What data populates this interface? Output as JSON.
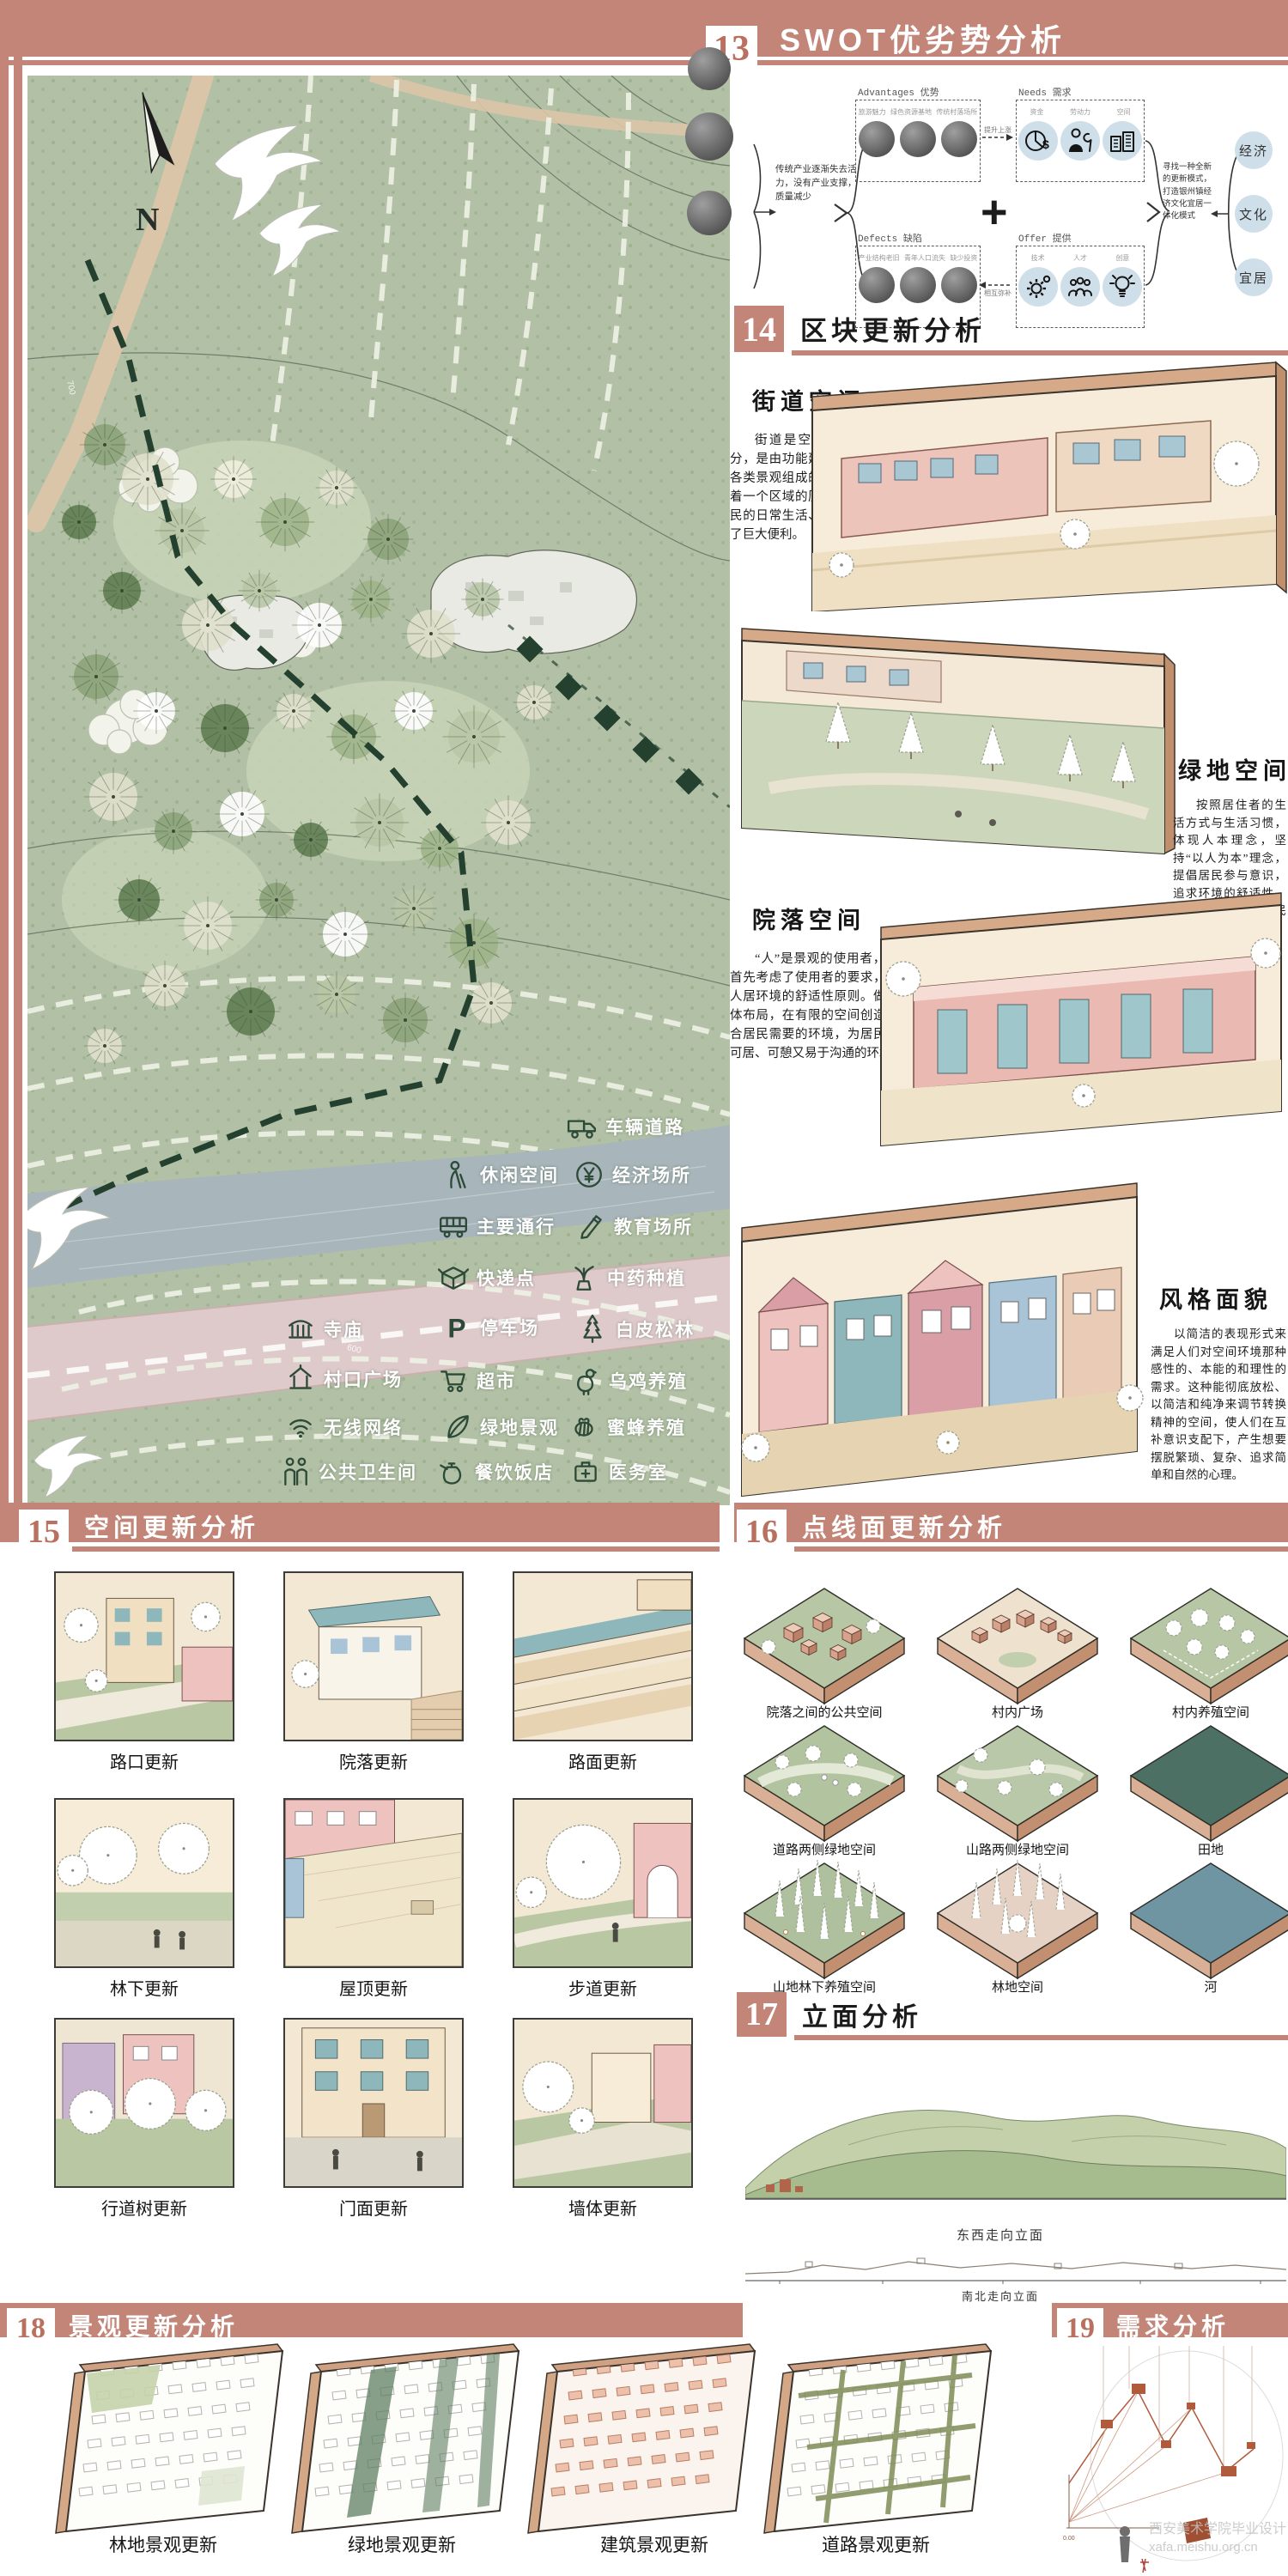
{
  "colors": {
    "band": "#c28577",
    "number": "#b9705f",
    "map_green": "#b2c1a5",
    "river": "#a8b5ba",
    "road_pink": "#decacb",
    "field_tile": "#4d7065",
    "river_tile": "#6f95a3",
    "diagram_rust": "#b15b3d",
    "legend_icon_green": "#2d4a38",
    "swot_circle_blue": "#cfdfe9"
  },
  "sections": {
    "s13": {
      "number": "13",
      "title": "SWOT优劣势分析"
    },
    "s14": {
      "number": "14",
      "title": "区块更新分析"
    },
    "s15": {
      "number": "15",
      "title": "空间更新分析"
    },
    "s16": {
      "number": "16",
      "title": "点线面更新分析"
    },
    "s17": {
      "number": "17",
      "title": "立面分析"
    },
    "s18": {
      "number": "18",
      "title": "景观更新分析"
    },
    "s19": {
      "number": "19",
      "title": "需求分析"
    }
  },
  "swot": {
    "intro_text": "传统产业逐渐失去活力，没有产业支撑，质量减少",
    "outro_text": "寻找一种全新的更新模式，打造银州镇经济文化宜居一体化模式",
    "arrow_top_label": "提升上涨",
    "arrow_bottom_label": "相互弥补",
    "plus": "+",
    "boxes": {
      "advantages": {
        "en": "Advantages",
        "zh": "优势",
        "items": [
          "旅游魅力",
          "绿色资源基地",
          "传统村落场所"
        ]
      },
      "needs": {
        "en": "Needs",
        "zh": "需求",
        "items": [
          "资金",
          "劳动力",
          "空间"
        ],
        "icons": [
          "money-icon",
          "worker-icon",
          "building-icon"
        ]
      },
      "defects": {
        "en": "Defects",
        "zh": "缺陷",
        "items": [
          "产业结构老旧",
          "青年人口流失",
          "缺少投资"
        ]
      },
      "offer": {
        "en": "Offer",
        "zh": "提供",
        "items": [
          "技术",
          "人才",
          "创意"
        ],
        "icons": [
          "gear-icon",
          "team-icon",
          "bulb-icon"
        ]
      }
    },
    "goals": [
      "经济",
      "文化",
      "宜居"
    ]
  },
  "map": {
    "north_label": "N",
    "contour_labels": [
      "700",
      "600"
    ],
    "legend": {
      "items": [
        {
          "icon": "truck-icon",
          "label": "车辆道路"
        },
        {
          "icon": "elder-icon",
          "label": "休闲空间"
        },
        {
          "icon": "coin-icon",
          "label": "经济场所"
        },
        {
          "icon": "bus-icon",
          "label": "主要通行"
        },
        {
          "icon": "pencil-icon",
          "label": "教育场所"
        },
        {
          "icon": "box-icon",
          "label": "快递点"
        },
        {
          "icon": "herb-icon",
          "label": "中药种植"
        },
        {
          "icon": "temple-icon",
          "label": "寺庙"
        },
        {
          "icon": "parking-icon",
          "label": "停车场"
        },
        {
          "icon": "pine-icon",
          "label": "白皮松林"
        },
        {
          "icon": "pavilion-icon",
          "label": "村口广场"
        },
        {
          "icon": "cart-icon",
          "label": "超市"
        },
        {
          "icon": "chicken-icon",
          "label": "乌鸡养殖"
        },
        {
          "icon": "wifi-icon",
          "label": "无线网络"
        },
        {
          "icon": "leaf-icon",
          "label": "绿地景观"
        },
        {
          "icon": "bee-icon",
          "label": "蜜蜂养殖"
        },
        {
          "icon": "people-icon",
          "label": "公共卫生间"
        },
        {
          "icon": "teapot-icon",
          "label": "餐饮饭店"
        },
        {
          "icon": "medkit-icon",
          "label": "医务室"
        }
      ]
    }
  },
  "block_update": {
    "panels": [
      {
        "title": "街道空间",
        "text": "街道是空间的重要组成部分，是由功能建筑、公共设施和各类景观组成的道路系统，承载着一个区域的历史和文化，为居民的日常生活、出行等活动提供了巨大便利。"
      },
      {
        "title": "绿地空间",
        "text": "按照居住者的生活方式与生活习惯，体现人本理念，坚持“以人为本”理念，提倡居民参与意识，追求环境的舒适性、多样性，实现对居民的不同需要的满足。"
      },
      {
        "title": "院落空间",
        "text": "“人”是景观的使用者，因此首先考虑了使用者的要求，坚持人居环境的舒适性原则。做好总体布局，在有限的空间创造出符合居民需要的环境，为居民提供可居、可憩又易于沟通的环境。"
      },
      {
        "title": "风格面貌",
        "text": "以简洁的表现形式来满足人们对空间环境那种感性的、本能的和理性的需求。这种能彻底放松、以简洁和纯净来调节转换精神的空间，使人们在互补意识支配下，产生想要摆脱繁琐、复杂、追求简单和自然的心理。"
      }
    ]
  },
  "space_update": {
    "tiles": [
      "路口更新",
      "院落更新",
      "路面更新",
      "林下更新",
      "屋顶更新",
      "步道更新",
      "行道树更新",
      "门面更新",
      "墙体更新"
    ]
  },
  "point_line_plane": {
    "tiles": [
      "院落之间的公共空间",
      "村内广场",
      "村内养殖空间",
      "道路两侧绿地空间",
      "山路两侧绿地空间",
      "田地",
      "山地林下养殖空间",
      "林地空间",
      "河"
    ]
  },
  "elevation": {
    "labels": [
      "东西走向立面",
      "南北走向立面"
    ]
  },
  "landscape_update": {
    "tiles": [
      "林地景观更新",
      "绿地景观更新",
      "建筑景观更新",
      "道路景观更新"
    ]
  },
  "watermark": {
    "line1": "西安美术学院毕业设计",
    "line2": "xafa.meishu.org.cn"
  }
}
